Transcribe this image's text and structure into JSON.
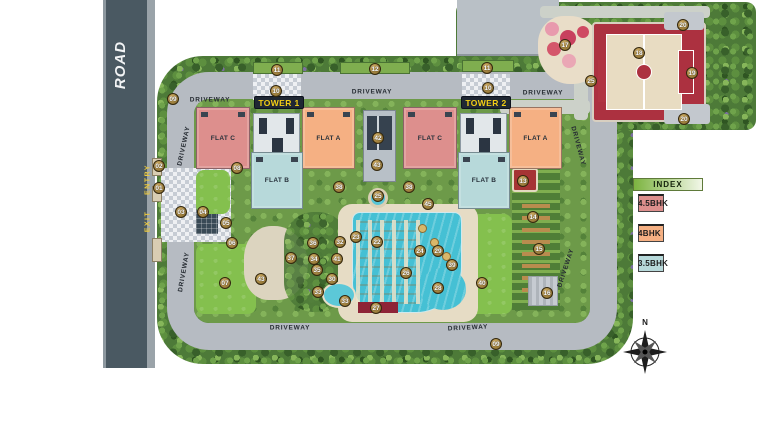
{
  "road": {
    "label": "ROAD",
    "entry": "ENTRY",
    "exit": "EXIT"
  },
  "towers": [
    {
      "label": "TOWER 1",
      "flats": [
        {
          "label": "FLAT C",
          "type": "4.5BHK"
        },
        {
          "label": "FLAT A",
          "type": "4BHK"
        },
        {
          "label": "FLAT B",
          "type": "3.5BHK"
        }
      ]
    },
    {
      "label": "TOWER 2",
      "flats": [
        {
          "label": "FLAT C",
          "type": "4.5BHK"
        },
        {
          "label": "FLAT A",
          "type": "4BHK"
        },
        {
          "label": "FLAT B",
          "type": "3.5BHK"
        }
      ]
    }
  ],
  "driveway_labels": [
    {
      "text": "DRIVEWAY",
      "x": 210,
      "y": 100,
      "rot": 0
    },
    {
      "text": "DRIVEWAY",
      "x": 372,
      "y": 92,
      "rot": 0
    },
    {
      "text": "DRIVEWAY",
      "x": 543,
      "y": 93,
      "rot": 0
    },
    {
      "text": "DRIVEWAY",
      "x": 184,
      "y": 146,
      "rot": -78
    },
    {
      "text": "DRIVEWAY",
      "x": 184,
      "y": 272,
      "rot": -80
    },
    {
      "text": "DRIVEWAY",
      "x": 290,
      "y": 328,
      "rot": 0
    },
    {
      "text": "DRIVEWAY",
      "x": 468,
      "y": 328,
      "rot": -3
    },
    {
      "text": "DRIVEWAY",
      "x": 578,
      "y": 146,
      "rot": 75
    },
    {
      "text": "DRIVEWAY",
      "x": 566,
      "y": 268,
      "rot": -72
    }
  ],
  "legend": {
    "title": "INDEX",
    "items": [
      {
        "label": "4.5BHK",
        "color": "#dd8f8d"
      },
      {
        "label": "4BHK",
        "color": "#f5b083"
      },
      {
        "label": "3.5BHK",
        "color": "#b7d9da"
      }
    ]
  },
  "compass": {
    "north_label": "N"
  },
  "colors": {
    "road": "#4a5962",
    "driveway": "#b6bbc2",
    "pool": "#45c0d4",
    "court_red": "#ac3140",
    "tower_label_bg": "#1f2733",
    "tower_label_text": "#f3ce15",
    "marker_gold": "#a5823f"
  },
  "markers": [
    {
      "n": "09",
      "x": 173,
      "y": 99
    },
    {
      "n": "11",
      "x": 277,
      "y": 70
    },
    {
      "n": "12",
      "x": 375,
      "y": 69
    },
    {
      "n": "11",
      "x": 487,
      "y": 68
    },
    {
      "n": "10",
      "x": 276,
      "y": 91
    },
    {
      "n": "10",
      "x": 488,
      "y": 88
    },
    {
      "n": "17",
      "x": 565,
      "y": 45
    },
    {
      "n": "18",
      "x": 639,
      "y": 53
    },
    {
      "n": "20",
      "x": 683,
      "y": 25
    },
    {
      "n": "19",
      "x": 692,
      "y": 73
    },
    {
      "n": "20",
      "x": 684,
      "y": 119
    },
    {
      "n": "25",
      "x": 591,
      "y": 81
    },
    {
      "n": "02",
      "x": 159,
      "y": 166
    },
    {
      "n": "01",
      "x": 159,
      "y": 188
    },
    {
      "n": "08",
      "x": 237,
      "y": 168
    },
    {
      "n": "03",
      "x": 181,
      "y": 212
    },
    {
      "n": "04",
      "x": 203,
      "y": 212
    },
    {
      "n": "05",
      "x": 226,
      "y": 223
    },
    {
      "n": "06",
      "x": 232,
      "y": 243
    },
    {
      "n": "07",
      "x": 225,
      "y": 283
    },
    {
      "n": "43",
      "x": 261,
      "y": 279
    },
    {
      "n": "37",
      "x": 291,
      "y": 258
    },
    {
      "n": "36",
      "x": 313,
      "y": 243
    },
    {
      "n": "34",
      "x": 314,
      "y": 259
    },
    {
      "n": "35",
      "x": 317,
      "y": 270
    },
    {
      "n": "41",
      "x": 337,
      "y": 259
    },
    {
      "n": "32",
      "x": 340,
      "y": 242
    },
    {
      "n": "23",
      "x": 356,
      "y": 237
    },
    {
      "n": "22",
      "x": 377,
      "y": 242
    },
    {
      "n": "30",
      "x": 332,
      "y": 279
    },
    {
      "n": "33",
      "x": 318,
      "y": 292
    },
    {
      "n": "33",
      "x": 345,
      "y": 301
    },
    {
      "n": "27",
      "x": 376,
      "y": 308
    },
    {
      "n": "26",
      "x": 406,
      "y": 273
    },
    {
      "n": "24",
      "x": 420,
      "y": 251
    },
    {
      "n": "29",
      "x": 438,
      "y": 251
    },
    {
      "n": "28",
      "x": 438,
      "y": 288
    },
    {
      "n": "39",
      "x": 452,
      "y": 265
    },
    {
      "n": "40",
      "x": 482,
      "y": 283
    },
    {
      "n": "45",
      "x": 428,
      "y": 204
    },
    {
      "n": "38",
      "x": 339,
      "y": 187
    },
    {
      "n": "38",
      "x": 409,
      "y": 187
    },
    {
      "n": "25",
      "x": 378,
      "y": 196
    },
    {
      "n": "42",
      "x": 378,
      "y": 138
    },
    {
      "n": "43",
      "x": 377,
      "y": 165
    },
    {
      "n": "13",
      "x": 523,
      "y": 181
    },
    {
      "n": "14",
      "x": 533,
      "y": 217
    },
    {
      "n": "15",
      "x": 539,
      "y": 249
    },
    {
      "n": "16",
      "x": 547,
      "y": 293
    },
    {
      "n": "09",
      "x": 496,
      "y": 344
    }
  ]
}
